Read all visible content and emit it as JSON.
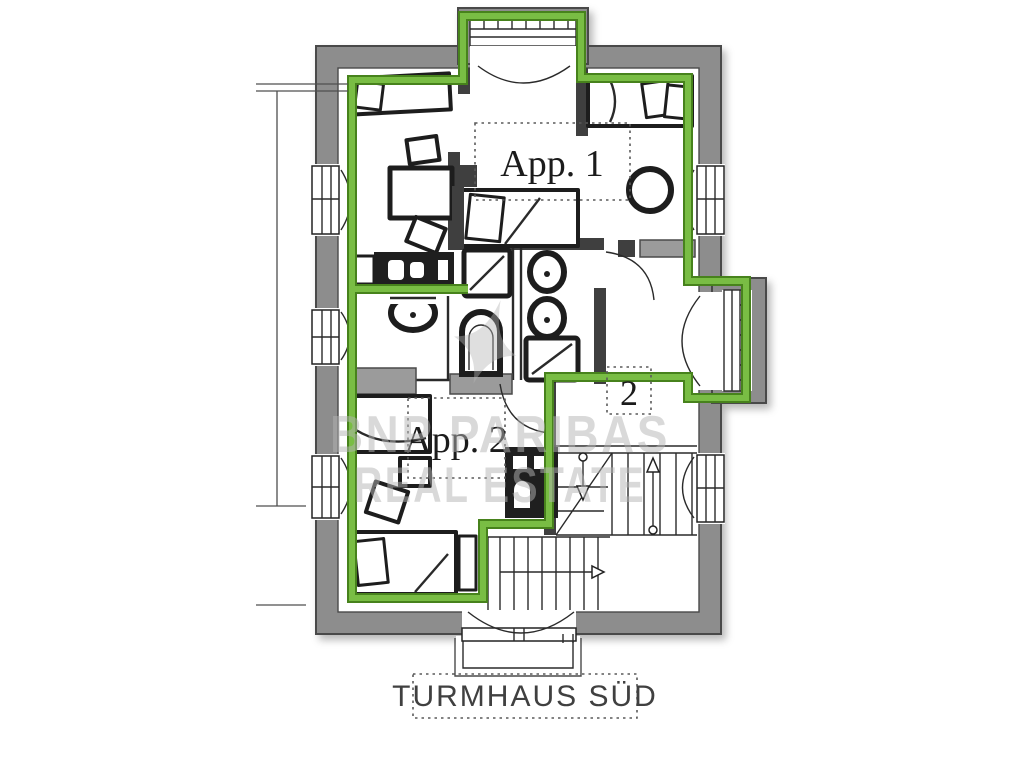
{
  "plan": {
    "title": "TURMHAUS SÜD",
    "apartment1_label": "App. 1",
    "apartment2_label": "App. 2",
    "stairwell_number": "2"
  },
  "watermark": {
    "line1": "BNP PARIBAS",
    "line2": "REAL ESTATE"
  },
  "colors": {
    "highlight-green": "#79bd44",
    "highlight-green-dark": "#47821c",
    "wall-gray": "#8d8d8d",
    "wall-dark": "#4a4a4a",
    "watermark-gray": "#b4b4b4",
    "label-ink": "#1b1b1b"
  }
}
